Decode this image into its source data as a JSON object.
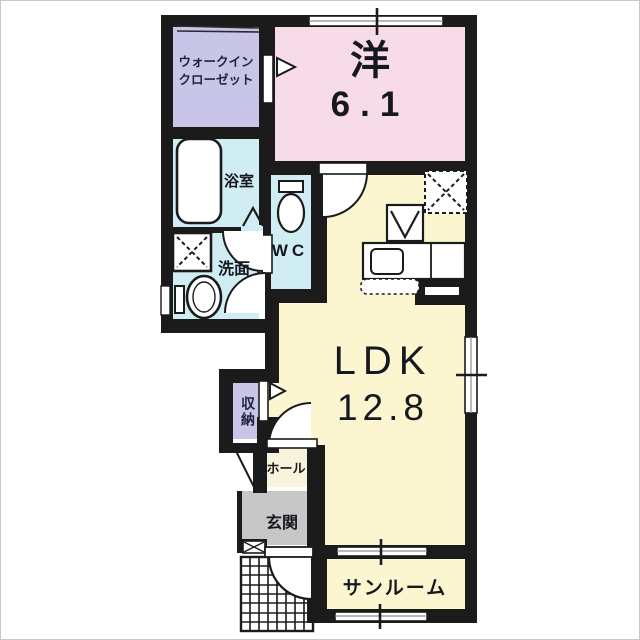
{
  "floorplan": {
    "title": "1LDK apartment floor plan",
    "rooms": {
      "walk_in_closet": {
        "label_line1": "ウォークイン",
        "label_line2": "クローゼット"
      },
      "western_room": {
        "label": "洋",
        "size": "6.1"
      },
      "bathroom": {
        "label": "浴室"
      },
      "washroom": {
        "label": "洗面"
      },
      "toilet": {
        "label": "WC"
      },
      "ldk": {
        "label": "LDK",
        "size": "12.8"
      },
      "storage": {
        "label": "収納"
      },
      "hall": {
        "label": "ホール"
      },
      "entrance": {
        "label": "玄関"
      },
      "sunroom": {
        "label": "サンルーム"
      }
    },
    "colors": {
      "wall": "#1b1b1b",
      "room_pink": "#f8dbe9",
      "room_purple": "#c8c5e9",
      "room_blue": "#d0edf4",
      "room_cream": "#fbf6cf",
      "hall_cream": "#f8f3dd",
      "entrance_gray": "#c7c7c7",
      "window_gray": "#8f8f8f",
      "background": "#ffffff"
    }
  }
}
